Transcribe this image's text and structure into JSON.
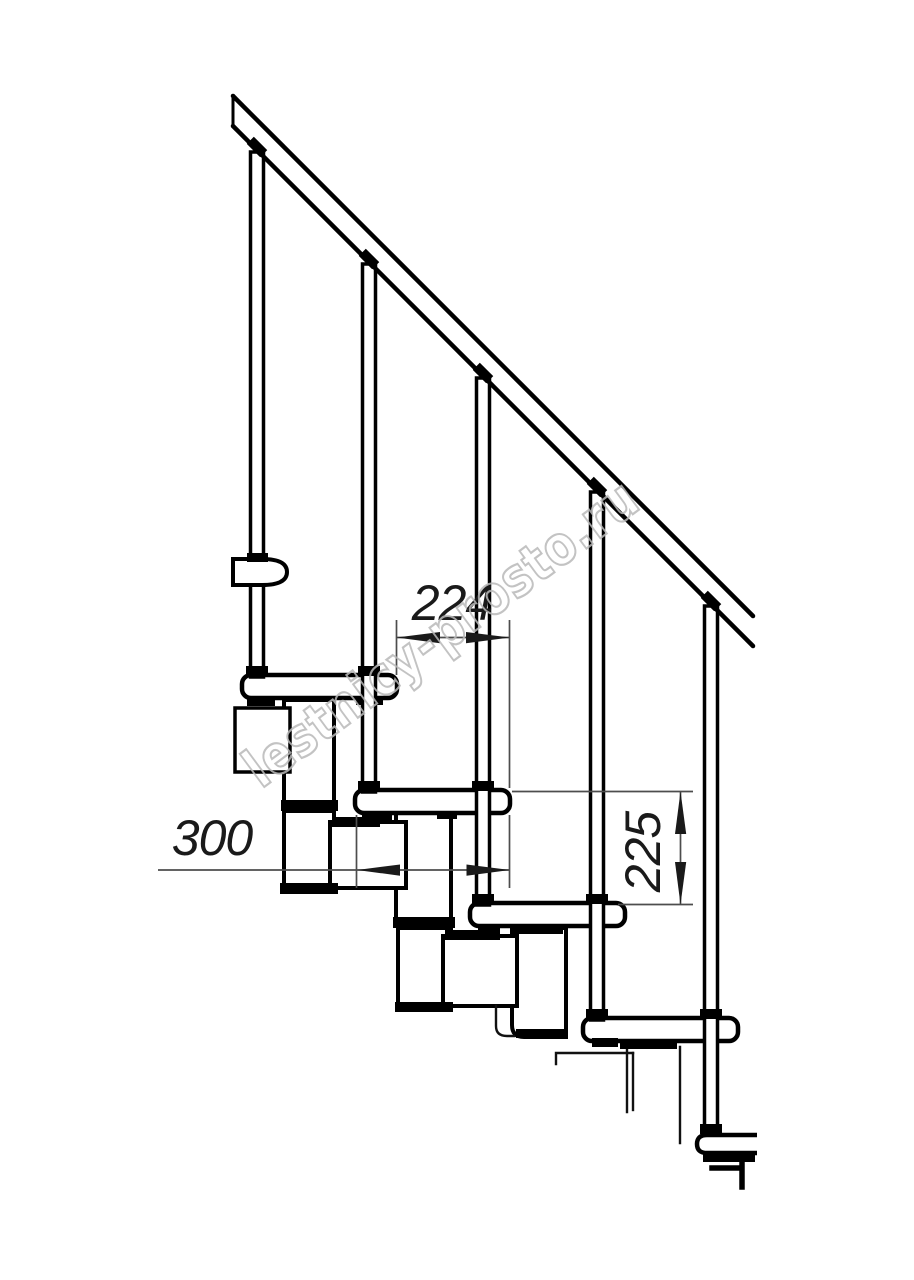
{
  "meta": {
    "title": "Modular staircase side view — technical drawing"
  },
  "watermark": {
    "text": "lestnicy-prosto.ru",
    "color": "#b9b9b9"
  },
  "dimensions": {
    "tread_run": {
      "label": "224"
    },
    "tread_depth": {
      "label": "300"
    },
    "step_rise": {
      "label": "225"
    }
  },
  "drawing": {
    "ink_color": "#000000",
    "dimension_color": "#4d4d4d",
    "background_color": "#ffffff",
    "tread_count": 5,
    "baluster_count": 5
  }
}
